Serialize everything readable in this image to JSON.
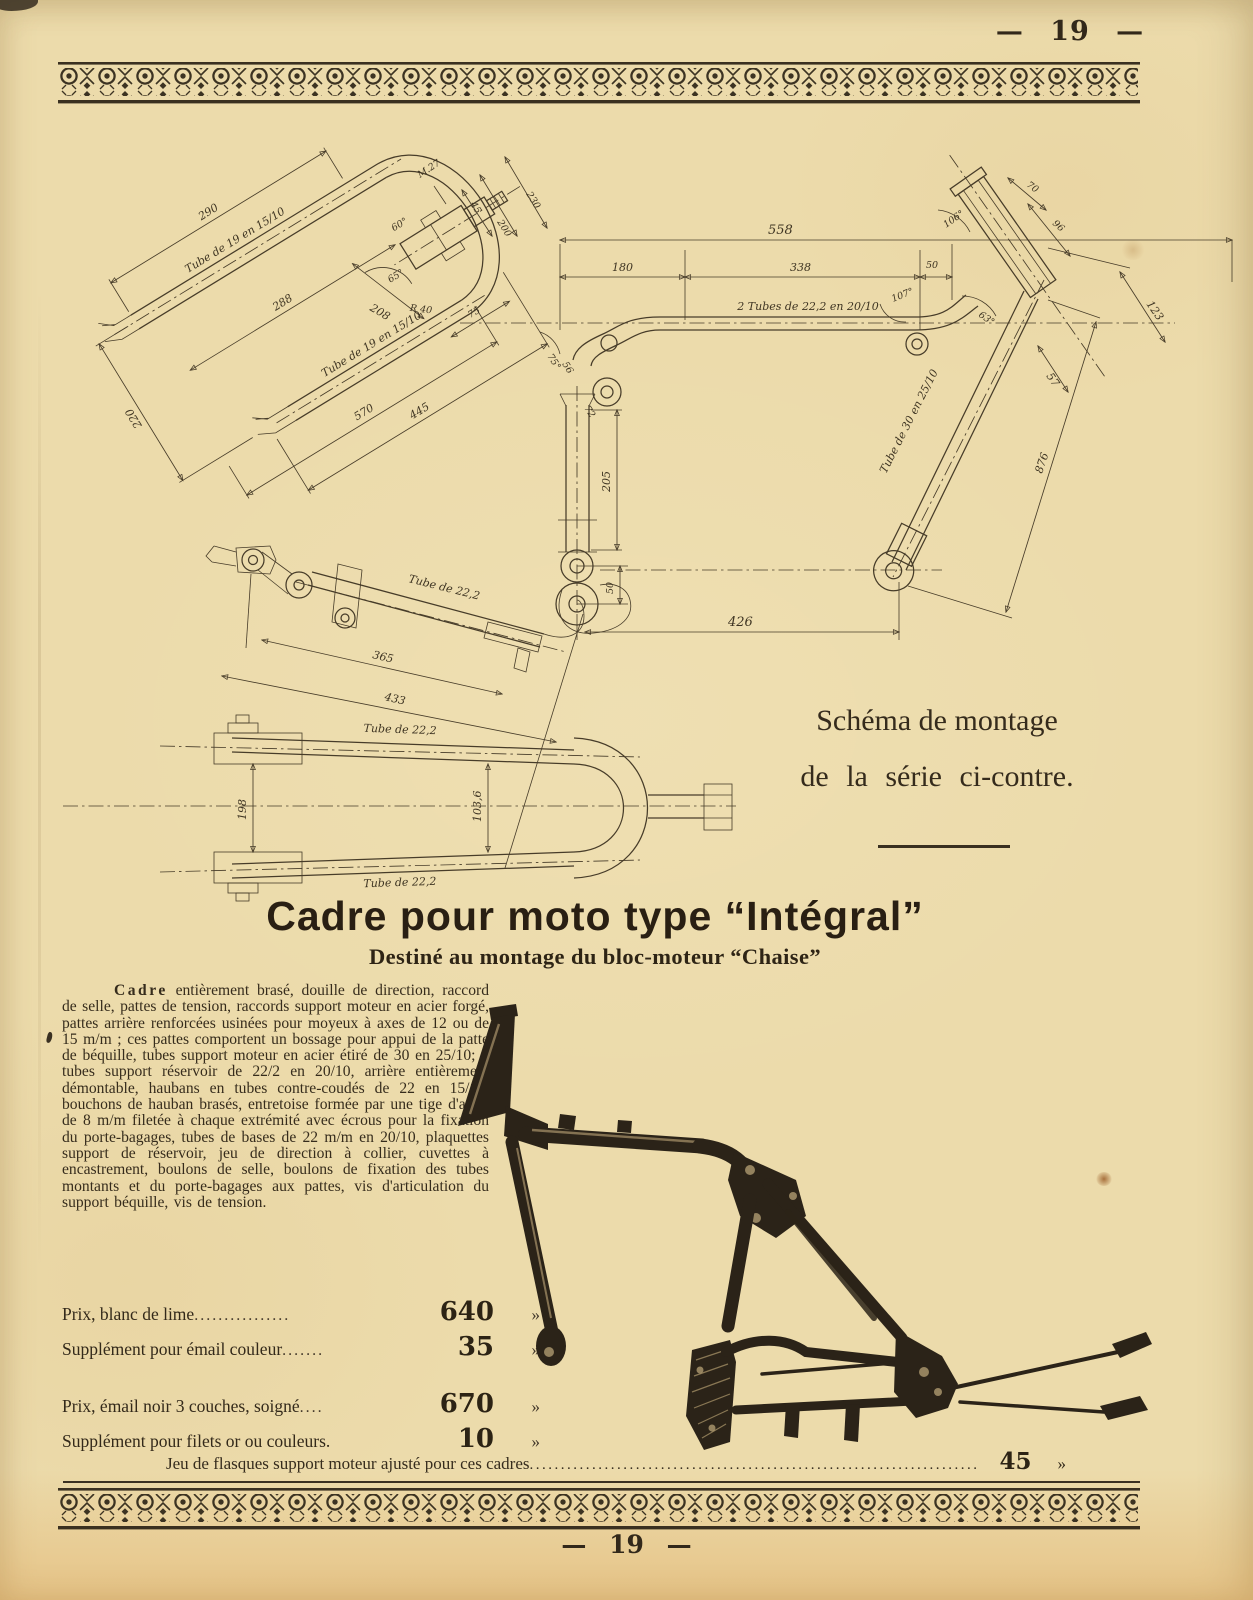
{
  "page": {
    "top": "— 19 —",
    "bottom": "— 19 —"
  },
  "note": {
    "line1": "Schéma de montage",
    "line2": "de la série ci-contre."
  },
  "heading": {
    "title": "Cadre pour moto type “Intégral”",
    "subtitle": "Destiné au montage du bloc-moteur “Chaise”"
  },
  "body": {
    "lead": "Cadre",
    "rest": " entièrement brasé, douille de direction, raccord de selle, pattes de tension, raccords support moteur en acier forgé, pattes arrière renforcées usinées pour moyeux à axes de 12 ou de 15 m/m ; ces pattes comportent un bossage pour appui de la patte de béquille, tubes support moteur en acier étiré de 30 en 25/10; 2 tubes support réservoir de 22/2 en 20/10, arrière entièrement démontable, haubans en tubes contre-coudés de 22 en 15/10, bouchons de hauban brasés, entretoise formée par une tige d'acier de 8 m/m filetée à chaque extrémité avec écrous pour la fixation du porte-bagages, tubes de bases de 22 m/m en 20/10, plaquettes support de réservoir, jeu de direction à collier, cuvettes à encastrement, boulons de selle, boulons de fixation des tubes montants et du porte-bagages aux pattes, vis d'articulation du support béquille, vis de tension."
  },
  "prices": {
    "rows": [
      {
        "label": "Prix, blanc de lime",
        "dots": "................",
        "value": "640",
        "unit": "»"
      },
      {
        "label": "Supplément pour émail couleur",
        "dots": ".......",
        "value": "35",
        "unit": "»"
      },
      {
        "label": "Prix, émail noir 3 couches, soigné",
        "dots": "....",
        "value": "670",
        "unit": "»"
      },
      {
        "label": "Supplément pour filets or ou couleurs.",
        "dots": "",
        "value": "10",
        "unit": "»"
      }
    ]
  },
  "bottom_line": {
    "label": "Jeu de flasques support moteur ajusté pour ces cadres",
    "dots": "........................................................................",
    "value": "45",
    "unit": "»"
  },
  "drawing": {
    "left": {
      "d290": "290",
      "t19a": "Tube de 19 en 15/10",
      "d288": "288",
      "d208": "208",
      "d220": "220",
      "d570": "570",
      "d445": "445",
      "t19b": "Tube de 19 en 15/10",
      "a65": "65°",
      "a60": "60°",
      "r40": "R 40",
      "m27": "M.27",
      "d45": "45",
      "d200": "200",
      "d230": "230",
      "d75": "75"
    },
    "right": {
      "d558": "558",
      "d180": "180",
      "d338": "338",
      "d50": "50",
      "t222": "2 Tubes de 22,2 en 20/10",
      "a107": "107°",
      "a106": "106°",
      "d70": "70",
      "d96": "96",
      "d123": "123",
      "d57": "57",
      "d876": "876",
      "t30": "Tube de 30 en 25/10",
      "d205": "205",
      "a75": "75°",
      "d56": "56",
      "d72": "72",
      "d50b": "50",
      "d426": "426"
    },
    "stay": {
      "t22": "Tube de 22,2",
      "d365": "365",
      "d433": "433"
    },
    "topview": {
      "t22top": "Tube de 22,2",
      "t22bot": "Tube de 22,2",
      "d198": "198",
      "d1036": "103,6"
    }
  }
}
